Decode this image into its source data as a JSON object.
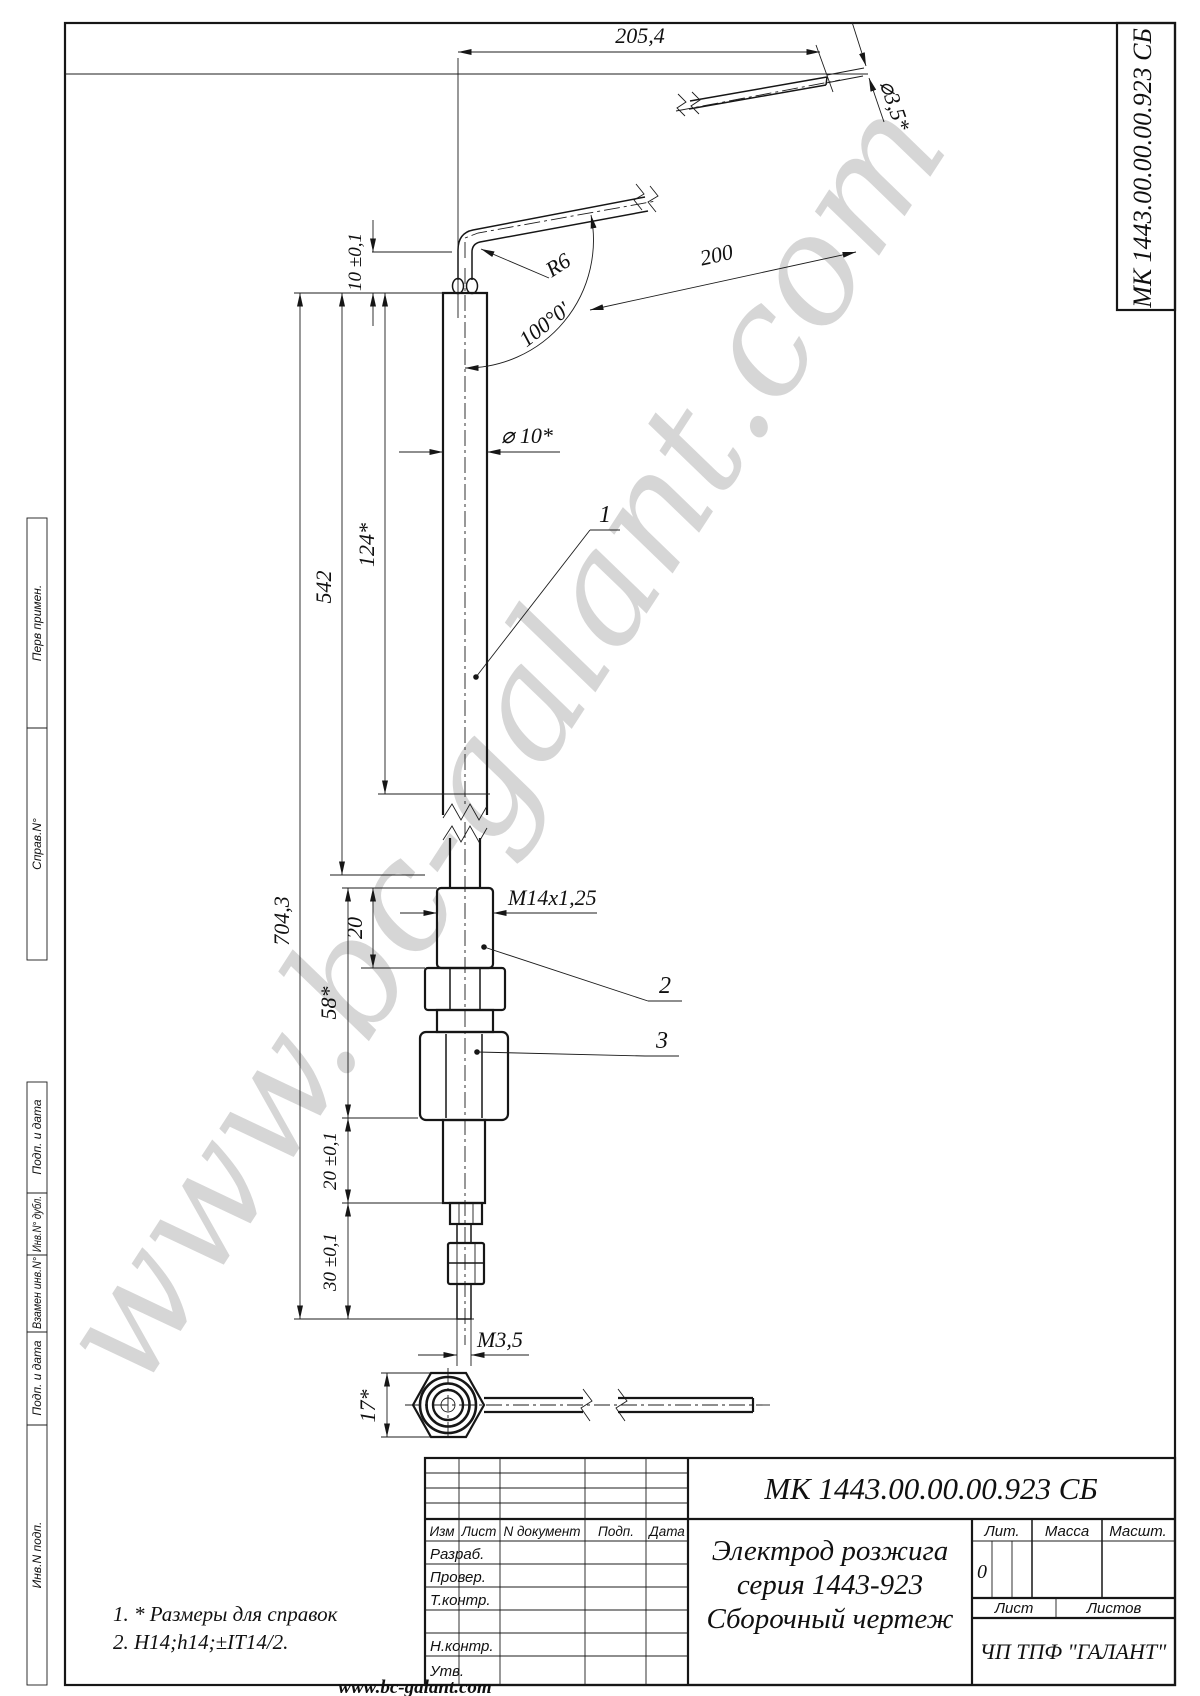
{
  "watermark": "www.bc-galant.com",
  "footer_url": "www.bc-galant.com",
  "corner_doc_number": "МК 1443.00.00.00.923 СБ",
  "margin_labels": [
    "Перв примен.",
    "Справ.N°",
    "Подп. и дата",
    "Инв.N° дубл.",
    "Взамен инв.N°",
    "Подп. и дата",
    "Инв.N подп."
  ],
  "dims": {
    "top_length": "205,4",
    "tip_dia": "⌀3,5*",
    "stickout": "10 ±0,1",
    "bend_radius": "R6",
    "bend_length": "200",
    "bend_angle": "100°0'",
    "body_dia": "⌀ 10*",
    "exposed_len": "124*",
    "ceramic_len": "542",
    "total_len": "704,3",
    "thread": "M14x1,25",
    "thread_len": "20",
    "mount_len": "58*",
    "stem_len": "20 ±0,1",
    "tail_len": "30 ±0,1",
    "tip_thread": "M3,5",
    "hex": "17*"
  },
  "parts": {
    "p1": "1",
    "p2": "2",
    "p3": "3"
  },
  "notes": [
    "1. * Размеры для справок",
    "2. H14;h14;±IT14/2."
  ],
  "title_block": {
    "doc_number": "МК 1443.00.00.00.923 СБ",
    "name_line1": "Электрод розжига",
    "name_line2": "серия 1443-923",
    "name_line3": "Сборочный чертеж",
    "company": "ЧП ТПФ \"ГАЛАНТ\"",
    "lit_value": "0",
    "col_izm": "Изм",
    "col_list": "Лист",
    "col_doc": "N документ",
    "col_podp": "Подп.",
    "col_data": "Дата",
    "row_razrab": "Разраб.",
    "row_prover": "Провер.",
    "row_tkontr": "Т.контр.",
    "row_nkontr": "Н.контр.",
    "row_utv": "Утв.",
    "lit": "Лит.",
    "massa": "Масса",
    "masht": "Масшт.",
    "list": "Лист",
    "listov": "Листов"
  }
}
